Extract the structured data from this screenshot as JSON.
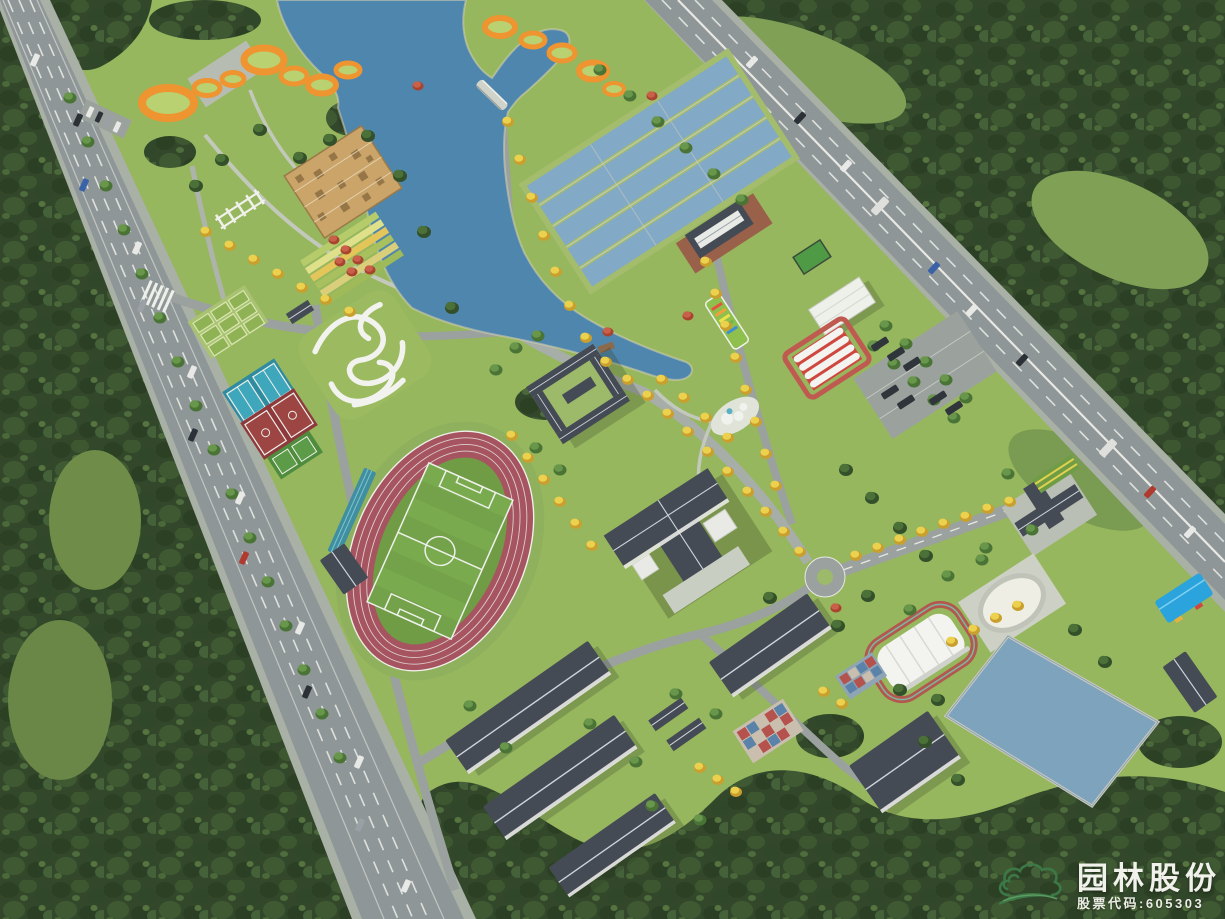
{
  "scene": {
    "alt": "Aerial 3D rendering of a campus sports park master plan with lake, running track, treatment pools, buildings and perimeter roads"
  },
  "watermark": {
    "company_name": "园林股份",
    "stock_label": "股票代码:605303",
    "logo_icon": "cloud-hill-logo"
  },
  "palette": {
    "lawn": "#97b75e",
    "meadow": "#7e9a52",
    "water": "#4e86ad",
    "pool_water": "#82a9c6",
    "pond_water": "#7ea3bd",
    "road": "#8f9697",
    "street": "#9aa19e",
    "track_red": "#a65560",
    "pitch_green": "#74a24a",
    "roof_dark": "#454b55",
    "ring_orange": "#ee9430",
    "ring_lawn": "#bad171",
    "tent_white": "#f3f3ef",
    "canopy_blue": "#2ba3dc",
    "court_teal": "#2f8ba0",
    "court_red": "#8e3a3c",
    "logo_green": "#3d7a48",
    "watermark_text": "#fbfbf6"
  }
}
